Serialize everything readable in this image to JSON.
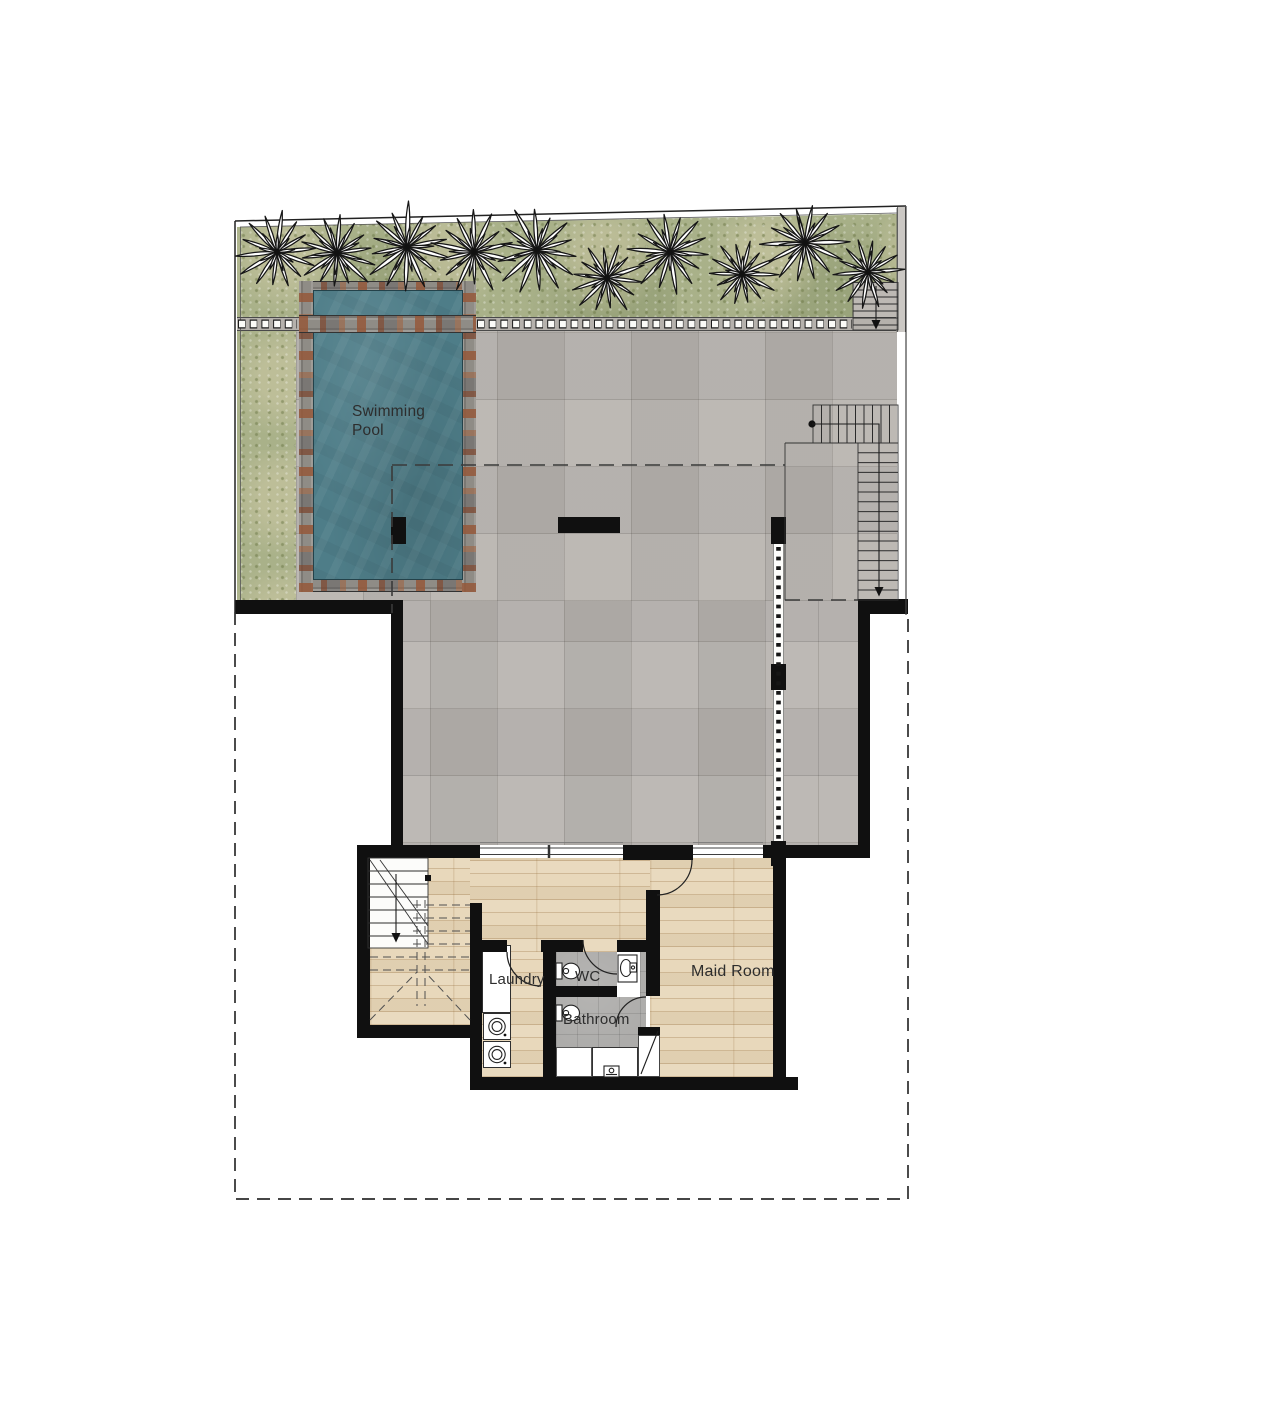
{
  "plan": {
    "type": "villa floor plan with pool terrace",
    "rooms": [
      {
        "id": "swimming_pool",
        "label": "Swimming Pool"
      },
      {
        "id": "laundry",
        "label": "Laundry"
      },
      {
        "id": "wc",
        "label": "WC"
      },
      {
        "id": "bathroom",
        "label": "Bathroom"
      },
      {
        "id": "maid_room",
        "label": "Maid Room"
      }
    ],
    "palette": {
      "grass": "#a9b189",
      "tile": "#b8b4af",
      "water": "#4e7d88",
      "stone": "#8f8c86",
      "stone_rust": "#95583a",
      "wood": "#e8d8bb",
      "bath_tile": "#adacaa",
      "wall": "#101010",
      "label_text": "#2d2d2d"
    },
    "icons": {
      "palm_tree": "palm-tree-icon",
      "stair_down_arrow": "stair-down-arrow-icon",
      "door_swing": "door-swing-arc",
      "toilet": "toilet-icon",
      "sink": "sink-icon",
      "washing_machine": "washing-machine-icon",
      "shower": "shower-faucet-icon"
    }
  }
}
